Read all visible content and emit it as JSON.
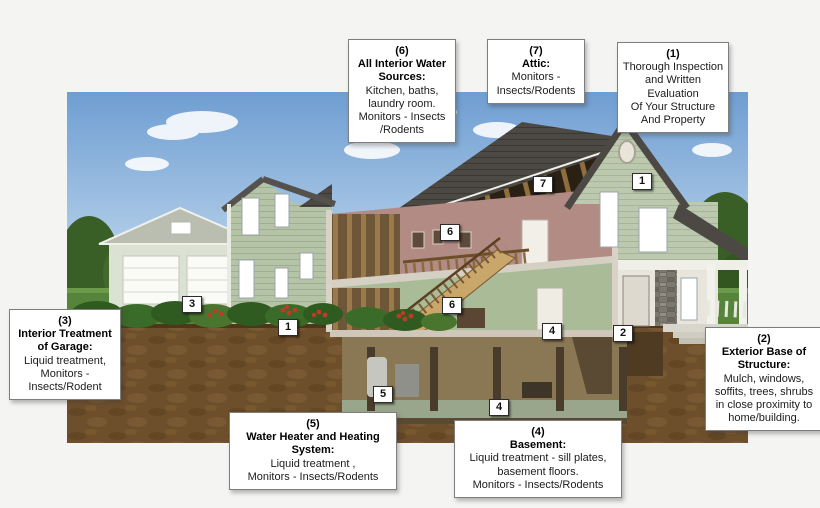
{
  "canvas": {
    "width": 820,
    "height": 508,
    "background": "#f4f4f2"
  },
  "palette": {
    "sky": "#7ba6d4",
    "lawn": "#57843b",
    "soil": "#6e4f2b",
    "siding_green": "#b5c3a7",
    "roof_gray": "#4c4945",
    "interior_mauve": "#b28b84",
    "interior_sage": "#a9bb97",
    "flower_red": "#c0392b",
    "box_border": "#7e7e7e",
    "text": "#1c1c1c"
  },
  "callouts": [
    {
      "id": "6",
      "number": "(6)",
      "title": "All Interior Water\nSources:",
      "body": "Kitchen, baths,\nlaundry room.\nMonitors - Insects\n/Rodents"
    },
    {
      "id": "7",
      "number": "(7)",
      "title": "Attic:",
      "body": "Monitors -\nInsects/Rodents"
    },
    {
      "id": "1",
      "number": "(1)",
      "title": "",
      "body": "Thorough Inspection\nand Written\nEvaluation\nOf Your Structure\nAnd Property"
    },
    {
      "id": "3",
      "number": "(3)",
      "title": "Interior Treatment\nof Garage:",
      "body": "Liquid treatment,\nMonitors -\nInsects/Rodent"
    },
    {
      "id": "2",
      "number": "(2)",
      "title": "Exterior Base of\nStructure:",
      "body": "Mulch, windows,\nsoffits, trees,  shrubs\nin close proximity to\nhome/building."
    },
    {
      "id": "5",
      "number": "(5)",
      "title": "Water Heater and Heating\nSystem:",
      "body": "Liquid treatment ,\nMonitors -  Insects/Rodents"
    },
    {
      "id": "4",
      "number": "(4)",
      "title": "Basement:",
      "body": "Liquid treatment - sill plates,\nbasement floors.\nMonitors - Insects/Rodents"
    }
  ],
  "markers": [
    {
      "label": "3",
      "x": 182,
      "y": 296
    },
    {
      "label": "1",
      "x": 278,
      "y": 319
    },
    {
      "label": "6",
      "x": 440,
      "y": 224
    },
    {
      "label": "6",
      "x": 442,
      "y": 297
    },
    {
      "label": "7",
      "x": 533,
      "y": 176
    },
    {
      "label": "1",
      "x": 632,
      "y": 173
    },
    {
      "label": "4",
      "x": 542,
      "y": 323
    },
    {
      "label": "2",
      "x": 613,
      "y": 325
    },
    {
      "label": "5",
      "x": 373,
      "y": 386
    },
    {
      "label": "4",
      "x": 489,
      "y": 399
    }
  ]
}
